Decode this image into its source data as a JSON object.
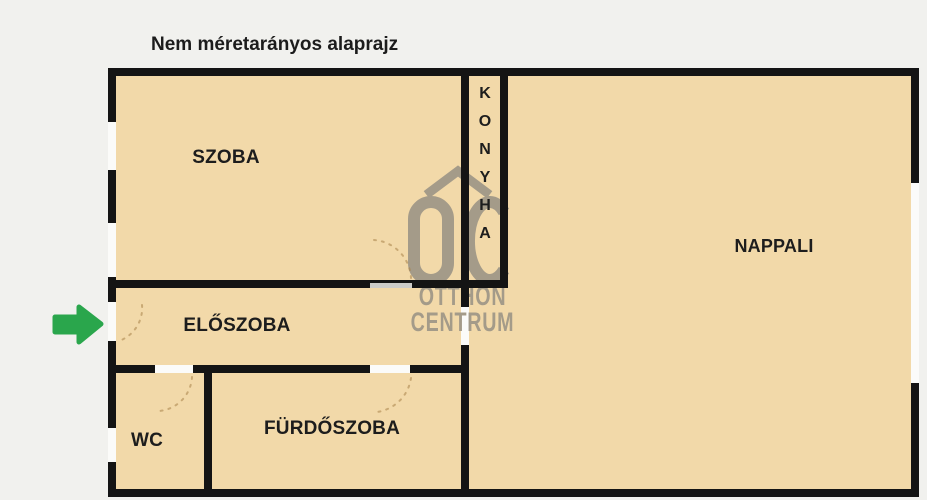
{
  "title": "Nem méretarányos alaprajz",
  "rooms": {
    "szoba": {
      "label": "SZOBA"
    },
    "konyha": {
      "label": "KONYHA",
      "label_vertical": "K\nO\nN\nY\nH\nA"
    },
    "nappali": {
      "label": "NAPPALI"
    },
    "eloszoba": {
      "label": "ELŐSZOBA"
    },
    "wc": {
      "label": "WC"
    },
    "furdoszoba": {
      "label": "FÜRDŐSZOBA"
    }
  },
  "watermark": {
    "logo": "OC",
    "line1": "OTTHON",
    "line2": "CENTRUM"
  },
  "entrance_arrow": {
    "direction": "right"
  },
  "colors": {
    "floor": "#f2d9a9",
    "wall": "#141414",
    "background": "#f1f1ee",
    "watermark": "#a49b89",
    "arrow": "#2aa64c",
    "label": "#1d1d1d"
  }
}
